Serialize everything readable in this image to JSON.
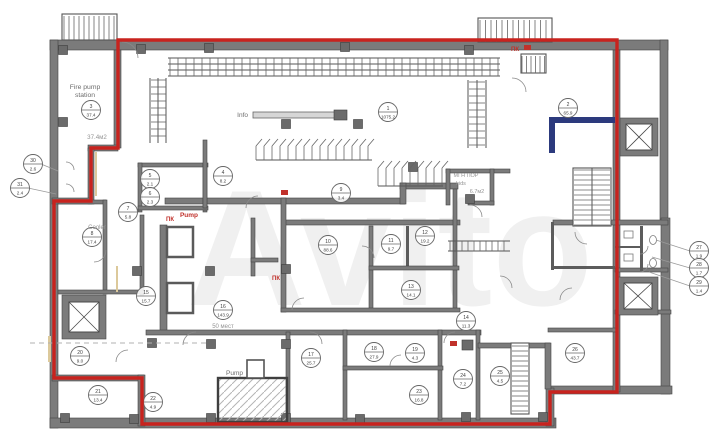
{
  "watermark": "Avito",
  "colors": {
    "red_outline": "#c8231e",
    "navy_wall": "#2c3a7d",
    "wall_gray": "#7b7b7b"
  },
  "labels": {
    "fire_pump_line1": "Fire pump",
    "fire_pump_line2": "station",
    "fire_pump_area": "37.4м2",
    "info": "Info",
    "cooler": "Cooler",
    "pump_upper": "Pump",
    "pump_lower": "Pump",
    "seats": "50 мест",
    "kids_line1": "МГН ПОР",
    "kids_line2": "kids",
    "kids_area": "6.7м2",
    "pk": "ПК"
  },
  "markers": [
    {
      "x": 388,
      "y": 112,
      "n": "1",
      "a": "1075.2"
    },
    {
      "x": 568,
      "y": 108,
      "n": "2",
      "a": "65.9"
    },
    {
      "x": 91,
      "y": 110,
      "n": "3",
      "a": "37.4"
    },
    {
      "x": 223,
      "y": 176,
      "n": "4",
      "a": "8.2"
    },
    {
      "x": 150,
      "y": 179,
      "n": "5",
      "a": "2.1"
    },
    {
      "x": 150,
      "y": 197,
      "n": "6",
      "a": "2.3"
    },
    {
      "x": 128,
      "y": 212,
      "n": "7",
      "a": "5.8"
    },
    {
      "x": 92,
      "y": 237,
      "n": "8",
      "a": "17.4"
    },
    {
      "x": 341,
      "y": 193,
      "n": "9",
      "a": "3.4"
    },
    {
      "x": 328,
      "y": 245,
      "n": "10",
      "a": "88.6"
    },
    {
      "x": 391,
      "y": 244,
      "n": "11",
      "a": "9.7"
    },
    {
      "x": 425,
      "y": 236,
      "n": "12",
      "a": "19.2"
    },
    {
      "x": 411,
      "y": 290,
      "n": "13",
      "a": "14.1"
    },
    {
      "x": 466,
      "y": 321,
      "n": "14",
      "a": "11.3"
    },
    {
      "x": 146,
      "y": 296,
      "n": "15",
      "a": "15.7"
    },
    {
      "x": 223,
      "y": 310,
      "n": "16",
      "a": "143.9"
    },
    {
      "x": 311,
      "y": 358,
      "n": "17",
      "a": "25.7"
    },
    {
      "x": 374,
      "y": 352,
      "n": "18",
      "a": "27.9"
    },
    {
      "x": 415,
      "y": 353,
      "n": "19",
      "a": "4.3"
    },
    {
      "x": 80,
      "y": 356,
      "n": "20",
      "a": "9.0"
    },
    {
      "x": 98,
      "y": 395,
      "n": "21",
      "a": "13.4"
    },
    {
      "x": 153,
      "y": 402,
      "n": "22",
      "a": "4.9"
    },
    {
      "x": 419,
      "y": 395,
      "n": "23",
      "a": "16.8"
    },
    {
      "x": 463,
      "y": 379,
      "n": "24",
      "a": "7.2"
    },
    {
      "x": 500,
      "y": 376,
      "n": "25",
      "a": "4.5"
    },
    {
      "x": 575,
      "y": 353,
      "n": "26",
      "a": "43.7"
    },
    {
      "x": 699,
      "y": 251,
      "n": "27",
      "a": "1.9"
    },
    {
      "x": 699,
      "y": 268,
      "n": "28",
      "a": "1.7"
    },
    {
      "x": 699,
      "y": 286,
      "n": "29",
      "a": "1.4"
    },
    {
      "x": 33,
      "y": 164,
      "n": "30",
      "a": "2.6"
    },
    {
      "x": 20,
      "y": 188,
      "n": "31",
      "a": "2.4"
    }
  ]
}
